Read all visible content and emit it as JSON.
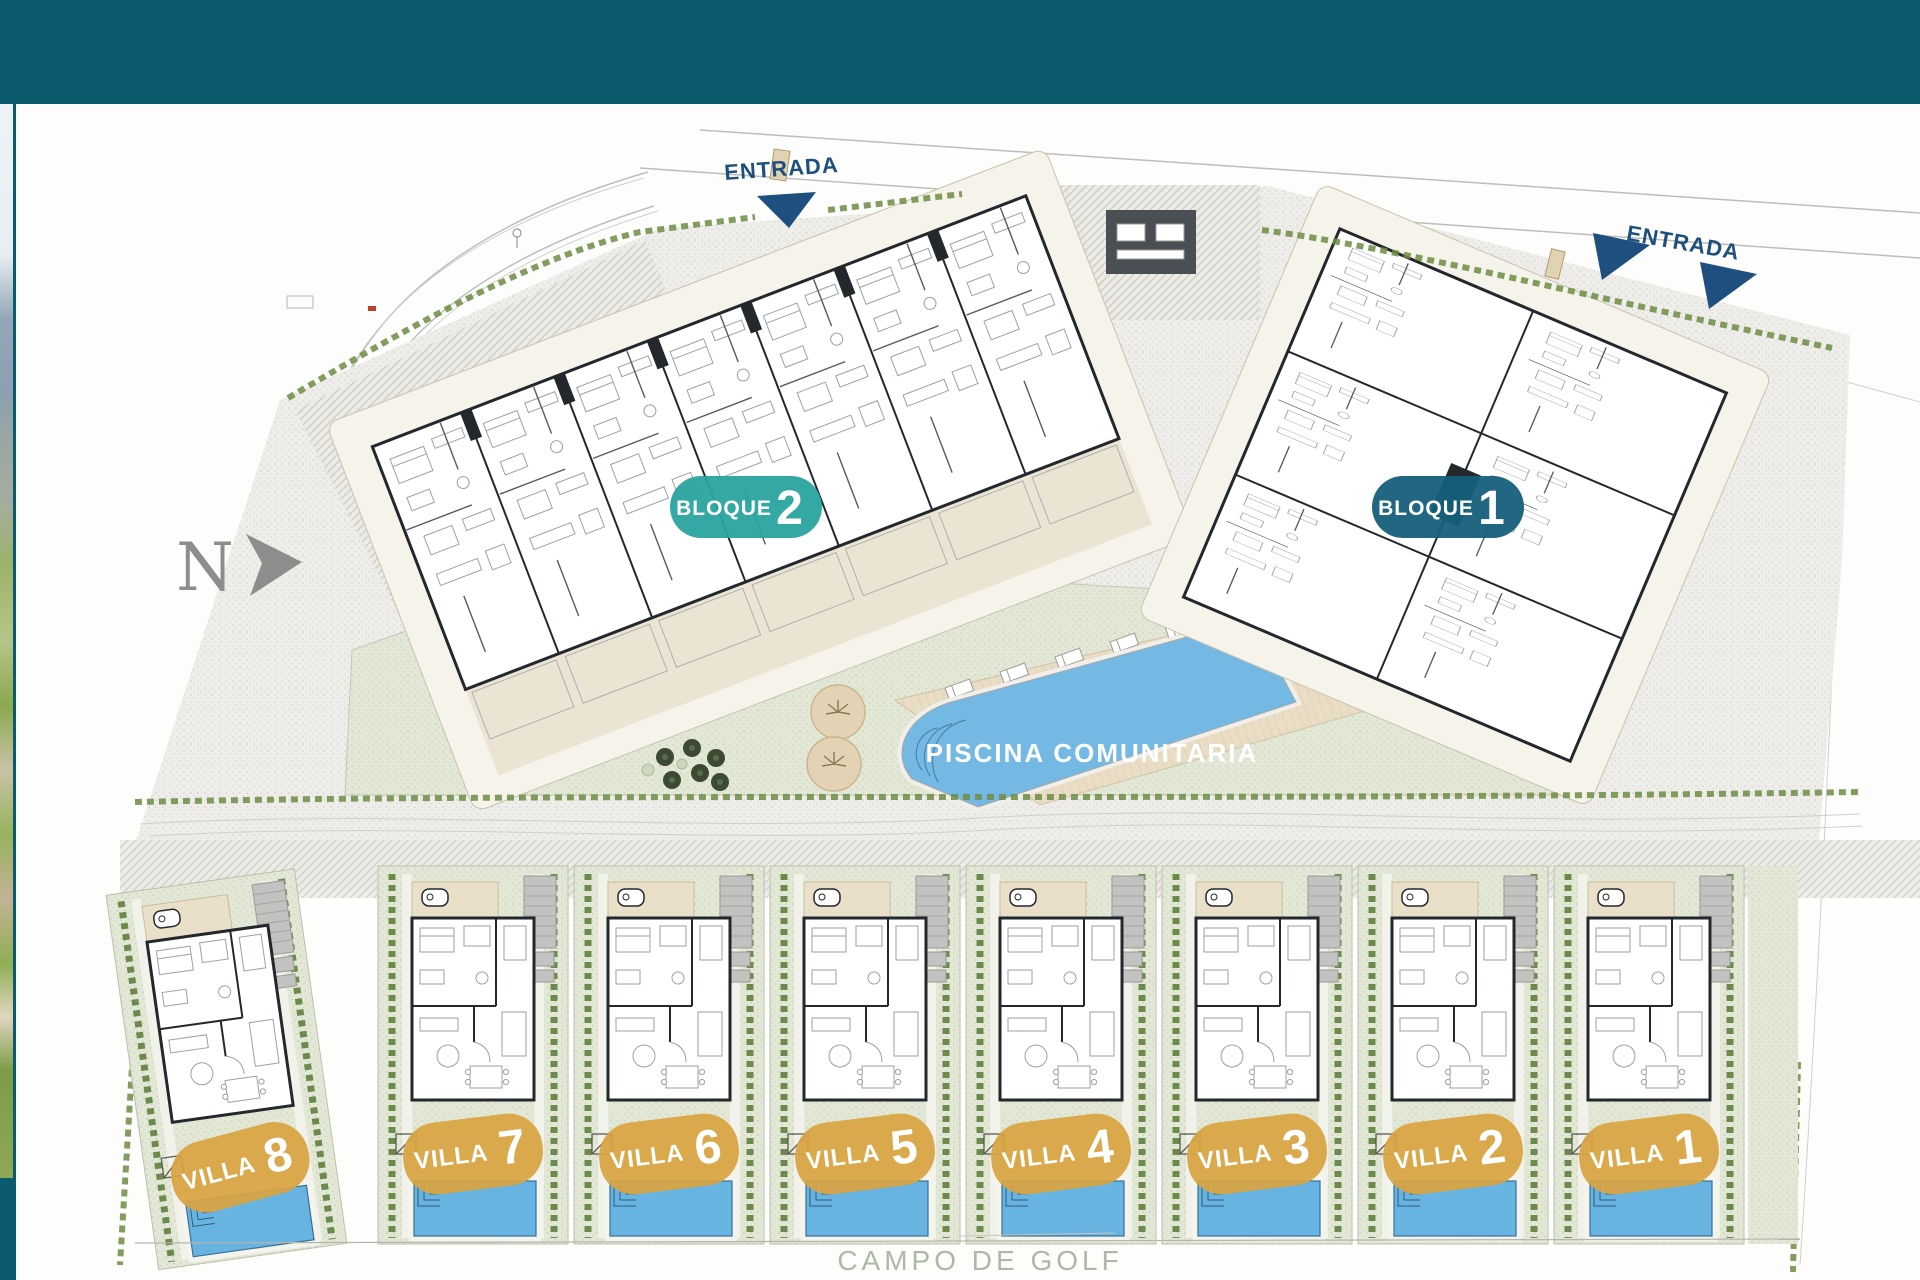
{
  "plan": {
    "north_label": "N",
    "entrances": [
      {
        "label": "ENTRADA"
      },
      {
        "label": "ENTRADA"
      }
    ],
    "blocks": [
      {
        "label": "BLOQUE",
        "number": "2"
      },
      {
        "label": "BLOQUE",
        "number": "1"
      }
    ],
    "community_pool": {
      "label": "PISCINA COMUNITARIA"
    },
    "villas": [
      {
        "label": "VILLA",
        "number": "8"
      },
      {
        "label": "VILLA",
        "number": "7"
      },
      {
        "label": "VILLA",
        "number": "6"
      },
      {
        "label": "VILLA",
        "number": "5"
      },
      {
        "label": "VILLA",
        "number": "4"
      },
      {
        "label": "VILLA",
        "number": "3"
      },
      {
        "label": "VILLA",
        "number": "2"
      },
      {
        "label": "VILLA",
        "number": "1"
      }
    ],
    "golf_label": "CAMPO DE GOLF"
  },
  "colors": {
    "header_teal": "#0b5a6d",
    "block2_badge_teal": "#29a49f",
    "block1_badge_teal": "#155f7a",
    "villa_badge_gold": "#d8a442",
    "entrance_navy": "#1e4f7e",
    "pool_blue": "#74b8e4",
    "villa_pool_blue": "#67b3e1",
    "lawn_green": "#e2e7d5",
    "deck_tan": "#e9ddc5",
    "wall_dark": "#23282d",
    "golf_text_gray": "#aeb8a6"
  }
}
